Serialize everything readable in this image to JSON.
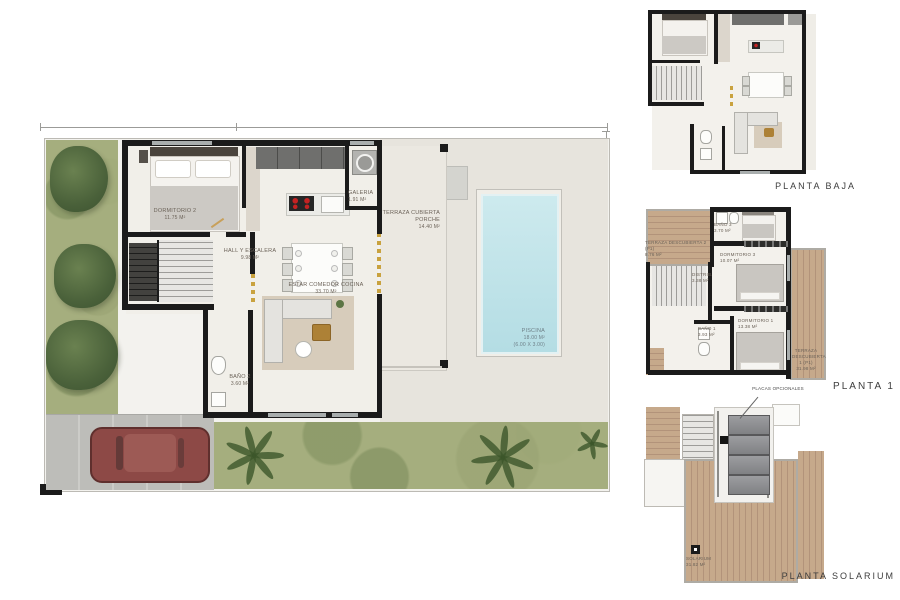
{
  "document": {
    "type": "villa floor plan brochure"
  },
  "colors": {
    "wall": "#1b1b1b",
    "grass": "#a5ae7e",
    "bush": "#4a613a",
    "pool": "#c2e4ea",
    "wood_deck": "#c6a98b",
    "paving": "#e7e4dd",
    "car": "#8d4946",
    "accent_gold": "#c9a23f",
    "label_text": "#6b6258",
    "title_text": "#3d3d3d"
  },
  "main_plan": {
    "rooms": [
      {
        "name": "DORMITORIO 2",
        "area": "11.75 m²"
      },
      {
        "name": "HALL Y ESCALERA",
        "area": "9.98 m²"
      },
      {
        "name": "ESTAR COMEDOR COCINA",
        "area": "33.70 m²"
      },
      {
        "name": "GALERIA",
        "area": "1.91 m²"
      },
      {
        "name": "TERRAZA CUBIERTA PORCHE",
        "area": "14.40 m²"
      },
      {
        "name": "BAÑO 2",
        "area": "3.60 m²"
      },
      {
        "name": "PISCINA",
        "area": "18.00 m²",
        "dims": "(6.00 x 3.00)"
      }
    ]
  },
  "planta_baja": {
    "title": "PLANTA BAJA"
  },
  "planta_1": {
    "title": "PLANTA 1",
    "rooms": [
      {
        "name": "TERRAZA DESCUBIERTA 2 (P1)",
        "area": "8.76 m²"
      },
      {
        "name": "BAÑO 3",
        "area": "3.70 m²"
      },
      {
        "name": "DORMITORIO 3",
        "area": "10.07 m²"
      },
      {
        "name": "DISTRIB.",
        "area": "3.38 m²"
      },
      {
        "name": "BAÑO 1",
        "area": "3.93 m²"
      },
      {
        "name": "DORMITORIO 1",
        "area": "13.38 m²"
      },
      {
        "name": "TERRAZA DESCUBIERTA 1 (P1)",
        "area": "31.98 m²"
      }
    ]
  },
  "planta_solarium": {
    "title": "PLANTA SOLARIUM",
    "annotation": "PLACAS OPCIONALES",
    "rooms": [
      {
        "name": "SOLARIUM",
        "area": "31.82 m²"
      }
    ]
  }
}
